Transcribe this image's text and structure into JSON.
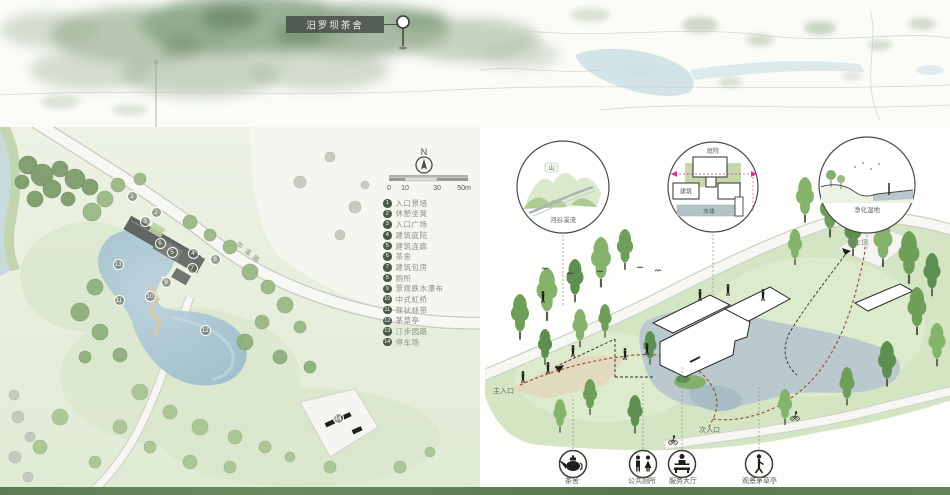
{
  "map": {
    "site_label": "汨罗坝茶舍"
  },
  "plan": {
    "north_label": "N",
    "scale_ticks": [
      "0",
      "10",
      "30",
      "50m"
    ],
    "road_label": "华溪路",
    "legend": [
      {
        "num": "1",
        "label": "入口景墙"
      },
      {
        "num": "2",
        "label": "休憩坐凳"
      },
      {
        "num": "3",
        "label": "入口广场"
      },
      {
        "num": "4",
        "label": "建筑庭院"
      },
      {
        "num": "5",
        "label": "建筑连廊"
      },
      {
        "num": "6",
        "label": "茶舍"
      },
      {
        "num": "7",
        "label": "建筑包房"
      },
      {
        "num": "8",
        "label": "厕所"
      },
      {
        "num": "9",
        "label": "景观跌水瀑布"
      },
      {
        "num": "10",
        "label": "中式虹桥"
      },
      {
        "num": "11",
        "label": "现状林带"
      },
      {
        "num": "12",
        "label": "茅草亭"
      },
      {
        "num": "13",
        "label": "汀步园路"
      },
      {
        "num": "14",
        "label": "停车场"
      }
    ]
  },
  "axon": {
    "bubbles": [
      {
        "caption": "河谷溪流",
        "tag": "山"
      },
      {
        "top_label": "庭院",
        "left_label": "建筑",
        "bottom_label": "水体"
      },
      {
        "caption": "净化湿地"
      }
    ],
    "labels": {
      "main_entrance": "主入口",
      "secondary_entrance": "次入口",
      "parking": "停车场"
    },
    "facilities": [
      {
        "label": "茶舍"
      },
      {
        "label": "公共厕所"
      },
      {
        "label": "服务大厅"
      },
      {
        "label": "观景茅草亭"
      }
    ]
  },
  "colors": {
    "label_bg": "#4e564e",
    "canopy_green": "#8aa687",
    "water_blue": "#b9c9ce",
    "accent_magenta": "#d6338f",
    "route_red": "#9c4f35"
  }
}
